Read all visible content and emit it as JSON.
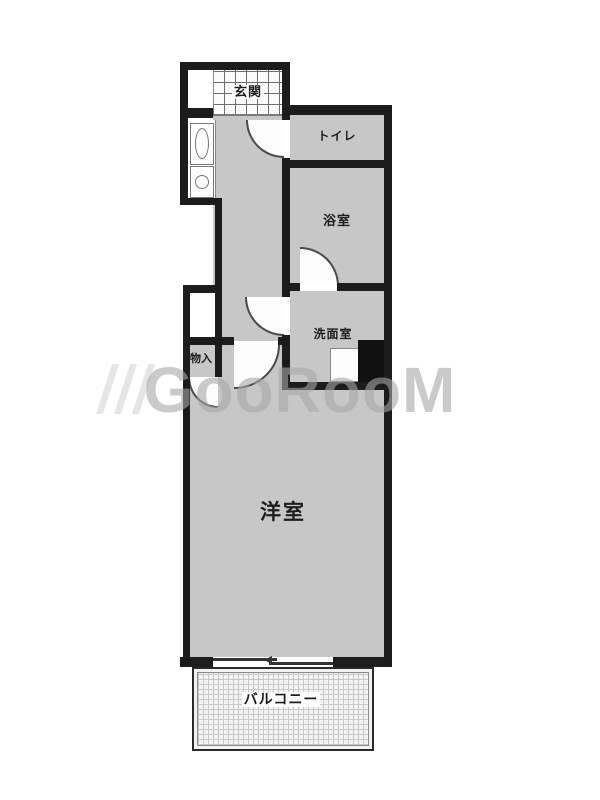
{
  "plan_title": "1K floor plan",
  "rooms": {
    "genkan": {
      "label": "玄関"
    },
    "toilet": {
      "label": "トイレ"
    },
    "bath": {
      "label": "浴室"
    },
    "washroom": {
      "label": "洗面室"
    },
    "closet": {
      "label": "物入"
    },
    "western_room": {
      "label": "洋室"
    },
    "balcony": {
      "label": "バルコニー"
    }
  },
  "watermark": {
    "text": "GooRooM"
  },
  "colors": {
    "wall": "#1c1c1c",
    "room_floor": "#c7c7c7",
    "genkan_tile_line": "#6e6e6e",
    "balcony_grid_line": "#c9c9c9",
    "watermark_gray": "#a7a7a7",
    "fixture_outline": "#777777",
    "pipe_space": "#111111"
  }
}
